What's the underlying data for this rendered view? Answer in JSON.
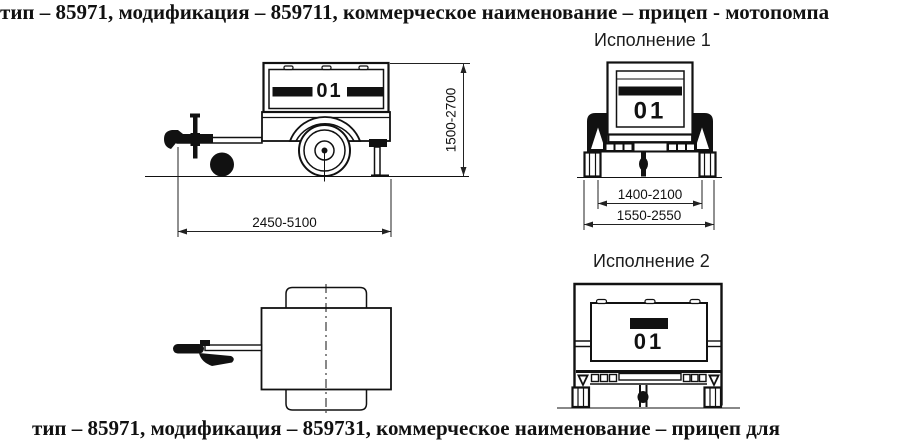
{
  "colors": {
    "ink": "#111111",
    "paper": "#ffffff"
  },
  "captions": {
    "top": "тип – 85971, модификация – 859711, коммерческое наименование – прицеп - мотопомпа",
    "bottom": "тип – 85971, модификация – 859731, коммерческое наименование – прицеп для",
    "variant1": "Исполнение 1",
    "variant2": "Исполнение 2"
  },
  "dimensions": {
    "overall_length": "2450-5100",
    "overall_height": "1500-2700",
    "track_width": "1400-2100",
    "overall_width": "1550-2550"
  },
  "markings": {
    "box_number": "01"
  }
}
